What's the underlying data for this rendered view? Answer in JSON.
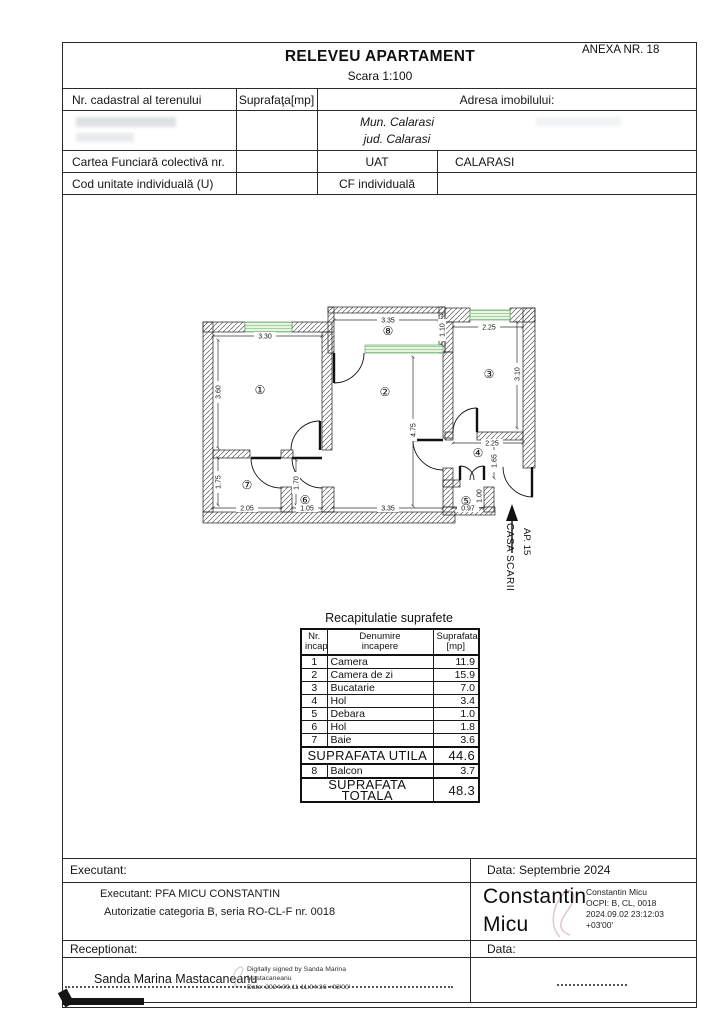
{
  "header": {
    "anexa": "ANEXA NR. 18",
    "title": "RELEVEU APARTAMENT",
    "scale": "Scara 1:100",
    "col1": "Nr. cadastral al terenului",
    "col2": "Suprafaţa[mp]",
    "col3": "Adresa imobilului:",
    "address_line1": "Mun. Calarasi",
    "address_line2": "jud. Calarasi",
    "row3_label": "Cartea Funciară colectivă nr.",
    "row3_uat": "UAT",
    "row3_city": "CALARASI",
    "row4_label": "Cod unitate individuală (U)",
    "row4_cf": "CF individuală"
  },
  "plan": {
    "rooms": {
      "r1": "①",
      "r2": "②",
      "r3": "③",
      "r4": "④",
      "r5": "⑤",
      "r6": "⑥",
      "r7": "⑦",
      "r8": "⑧"
    },
    "dims": {
      "room1_w": "3.30",
      "room1_h": "3.60",
      "room2_w": "3.35",
      "room2_h": "4.75",
      "room3_w": "2.25",
      "room3_h": "3.10",
      "room4_w": "2.25",
      "room4_h": "1.65",
      "room5_w": "0.97",
      "room5_h": "1.00",
      "room6_w": "1.05",
      "room6_h": "1.70",
      "room7_w": "2.05",
      "room7_h": "1.75",
      "balcony_w": "3.35",
      "balcony_h": "1.10"
    },
    "stairs_ap": "AP. 15",
    "stairs_casa": "CASA SCARII"
  },
  "recap": {
    "title": "Recapitulatie suprafete",
    "h_nr_1": "Nr.",
    "h_nr_2": "incap.",
    "h_den_1": "Denumire",
    "h_den_2": "incapere",
    "h_sup_1": "Suprafata",
    "h_sup_2": "[mp]",
    "rows": [
      [
        "1",
        "Camera",
        "11.9"
      ],
      [
        "2",
        "Camera de zi",
        "15.9"
      ],
      [
        "3",
        "Bucatarie",
        "7.0"
      ],
      [
        "4",
        "Hol",
        "3.4"
      ],
      [
        "5",
        "Debara",
        "1.0"
      ],
      [
        "6",
        "Hol",
        "1.8"
      ],
      [
        "7",
        "Baie",
        "3.6"
      ]
    ],
    "utila_label": "SUPRAFATA UTILA",
    "utila_value": "44.6",
    "row8": [
      "8",
      "Balcon",
      "3.7"
    ],
    "totala_label": "SUPRAFATA TOTALA",
    "totala_value": "48.3"
  },
  "footer": {
    "executant_label": "Executant:",
    "data_label_top": "Data: Septembrie 2024",
    "executant_line1": "Executant: PFA MICU CONSTANTIN",
    "executant_line2": "Autorizatie categoria B, seria RO-CL-F nr. 0018",
    "sig1_name_line1": "Constantin",
    "sig1_name_line2": "Micu",
    "sig1_details": [
      "Constantin Micu",
      "OCPI: B, CL, 0018",
      "2024.09.02 23:12:03",
      "+03'00'"
    ],
    "receptionat_label": "Receptionat:",
    "data_label_bottom": "Data:",
    "sig2_name": "Sanda Marina Mastacaneanu",
    "sig2_details": [
      "Digitally signed by Sanda Marina",
      "Mastacaneanu",
      "Date: 2024.09.11 11:04:36 +03'00'"
    ]
  }
}
